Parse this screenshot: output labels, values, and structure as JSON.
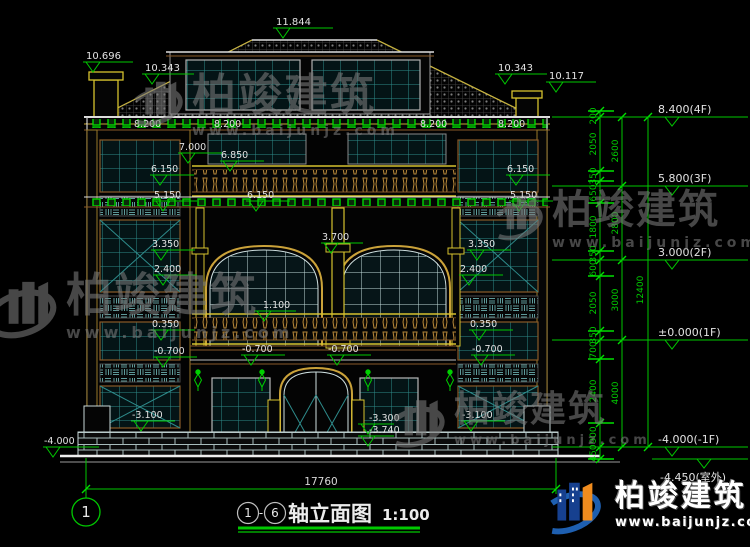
{
  "brand": {
    "name": "柏竣建筑",
    "site": "www.baijunjz.com"
  },
  "title_block": {
    "axis_start": "1",
    "separator": "-",
    "axis_end": "6",
    "title": "轴立面图",
    "scale": "1:100"
  },
  "axis": {
    "bubble": "1"
  },
  "dimensions": {
    "overall_width": "17760",
    "overall_height": "12400",
    "floor_heights": [
      "2600",
      "2800",
      "3000",
      "4000"
    ],
    "segments": [
      "200",
      "2050",
      "350",
      "650",
      "1800",
      "350",
      "600",
      "2050",
      "350",
      "700",
      "2400",
      "900",
      "450"
    ],
    "floor_levels": [
      "8.400(4F)",
      "5.800(3F)",
      "3.000(2F)",
      "±0.000(1F)",
      "-4.000(-1F)",
      "-4.450(室外)"
    ]
  },
  "elevation_marks": {
    "ridge": "11.844",
    "chimney_left": "10.696",
    "roof_left": "10.343",
    "roof_right": "10.343",
    "chimney_right": "10.117",
    "eave": "8.200",
    "balcony_top": "7.000",
    "balcony_rail": "6.850",
    "band_3f": "6.150",
    "window_3f": "5.150",
    "arch_capital": "3.700",
    "window_2f_top": "3.350",
    "window_2f_sill": "2.400",
    "rail_2f": "1.100",
    "band_1f": "0.350",
    "terrace": "-0.700",
    "basement_window": "-3.100",
    "entry_floor": "-3.300",
    "entry_ground": "-3.740",
    "basement_floor": "-4.000"
  }
}
